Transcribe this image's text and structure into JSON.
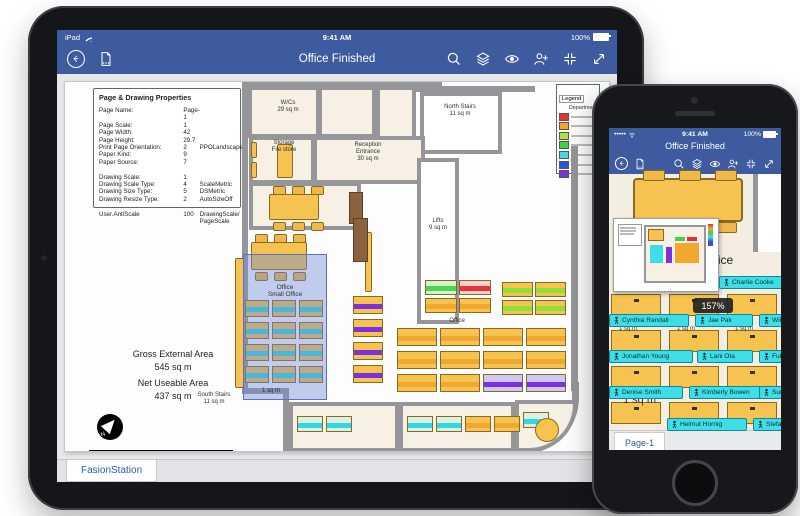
{
  "ipad": {
    "status": {
      "carrier": "iPad",
      "time": "9:41 AM",
      "battery": "100%"
    },
    "toolbar": {
      "title": "Office Finished"
    },
    "tab": "FasionStation",
    "properties": {
      "title": "Page & Drawing Properties",
      "rows": [
        {
          "label": "Page Name:",
          "value": "Page-1",
          "extra": ""
        },
        {
          "label": "Page Scale:",
          "value": "1",
          "extra": ""
        },
        {
          "label": "Page Width:",
          "value": "42",
          "extra": ""
        },
        {
          "label": "Page Height:",
          "value": "29.7",
          "extra": ""
        },
        {
          "label": "Print Page Orientation:",
          "value": "2",
          "extra": "PPOLandscape"
        },
        {
          "label": "Paper Kind:",
          "value": "9",
          "extra": ""
        },
        {
          "label": "Paper Source:",
          "value": "7",
          "extra": ""
        },
        {
          "label": "",
          "value": "",
          "extra": ""
        },
        {
          "label": "Drawing Scale:",
          "value": "1",
          "extra": ""
        },
        {
          "label": "Drawing Scale Type:",
          "value": "4",
          "extra": "ScaleMetric"
        },
        {
          "label": "Drawing Size Type:",
          "value": "5",
          "extra": "DSMetric"
        },
        {
          "label": "Drawing Resize Type:",
          "value": "2",
          "extra": "AutoSizeOff"
        },
        {
          "label": "",
          "value": "",
          "extra": ""
        },
        {
          "label": "User.AntiScale",
          "value": "100",
          "extra": "DrawingScale/ PageScale"
        }
      ]
    },
    "legend": {
      "title": "Legend",
      "subtitle": "Department",
      "colors": [
        "#e53238",
        "#f5a623",
        "#b5e041",
        "#3fd24a",
        "#41dbe8",
        "#2953d6",
        "#7e2fe0"
      ]
    },
    "plan": {
      "wcs": "W/Cs\n29 sq m",
      "north_stairs": "North Stairs\n11 sq m",
      "storage": "Storage\nFile store",
      "reception": "Reception\nEntrance\n30 sq m",
      "lifts": "Lifts\n9 sq m",
      "office_small_1": "Office",
      "office_small_2": "Small Office",
      "office_large": "Office",
      "south_stairs": "South Stairs\n11 sq m",
      "unit_area": "1 sq m",
      "gross_label": "Gross External Area",
      "gross_value": "545 sq m",
      "net_label": "Net Useable Area",
      "net_value": "437 sq m"
    }
  },
  "iphone": {
    "status": {
      "time": "9:41 AM",
      "battery": "100%"
    },
    "title": "Office Finished",
    "zoom_badge": "157%",
    "labels": {
      "office_1": "Office",
      "office_2": "Small Office",
      "unit_area": "1 sq m"
    },
    "names": [
      "Charlie Cooke",
      "Cynthia Randall",
      "Jae Pak",
      "William Vong",
      "Jonathan Young",
      "Lani Ota",
      "Fukiko Ogisu",
      "Denise Smith",
      "Kimberly Bowen",
      "Sunil Koduri",
      "Helmut Hornig",
      "Stefan Knorr"
    ],
    "tab": "Page-1"
  }
}
